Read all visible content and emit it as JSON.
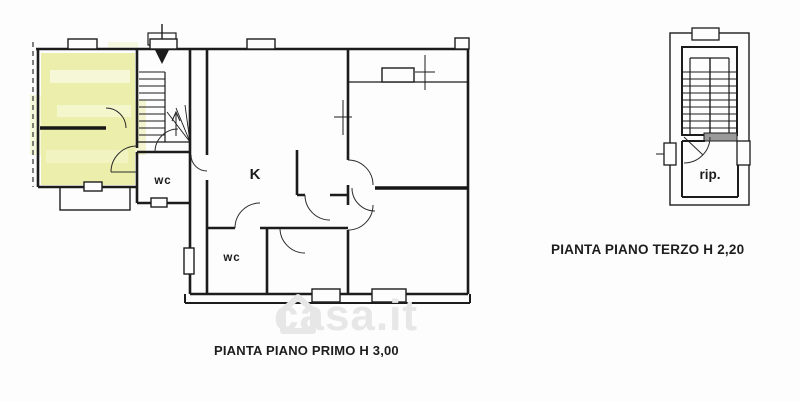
{
  "plans": {
    "primo": {
      "caption": "PIANTA PIANO PRIMO H 3,00",
      "rooms": {
        "kitchen": "K",
        "wc_upper": "wc",
        "wc_lower": "wc"
      }
    },
    "terzo": {
      "caption": "PIANTA PIANO TERZO H 2,20",
      "rooms": {
        "storage": "rip."
      }
    }
  },
  "watermark": {
    "text": "casa.it"
  },
  "colors": {
    "wall": "#1c1c1c",
    "highlight": "#ecefab",
    "background": "#fdfdfd",
    "watermark": "#e7e7e7"
  }
}
